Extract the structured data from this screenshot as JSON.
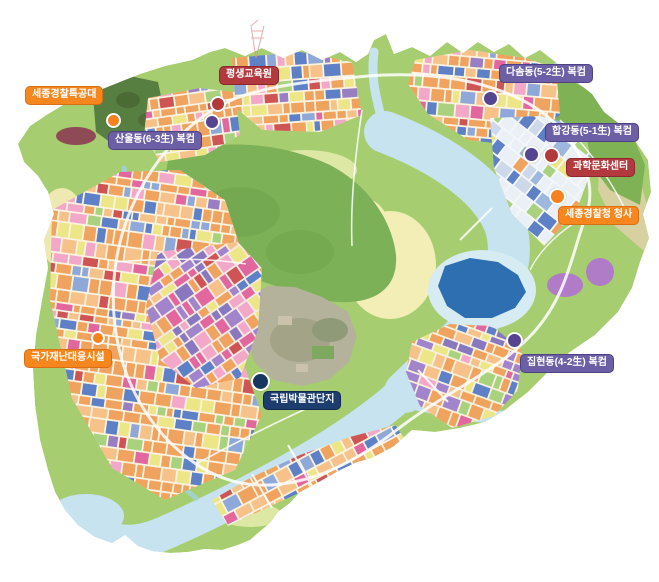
{
  "title": "세종시 시설 위치 지도",
  "colors": {
    "label_orange": "#f6871f",
    "label_orange_border": "#d96e14",
    "label_crimson": "#b23a3e",
    "label_crimson_border": "#8e262e",
    "label_purple": "#6d5fa5",
    "label_purple_border": "#4e4185",
    "label_navy": "#1c3d6e",
    "label_navy_border": "#12294e",
    "dot_orange": "#f5821f",
    "dot_red": "#b23a3a",
    "dot_purple": "#55448f",
    "dot_navy": "#17375f",
    "land_green": "#a6cd6f",
    "river_blue": "#c6e3ef",
    "lake_blue": "#2e6fb2"
  },
  "labels": [
    {
      "id": "sejong-police-swat",
      "text": "세종경찰특공대",
      "variant": "orange",
      "x": 25,
      "y": 86,
      "dot": {
        "x": 113,
        "y": 120,
        "color": "orange",
        "size": 11
      }
    },
    {
      "id": "lifelong-education-center",
      "text": "평생교육원",
      "variant": "crimson",
      "x": 219,
      "y": 66,
      "dot": {
        "x": 218,
        "y": 104,
        "color": "red",
        "size": 12
      }
    },
    {
      "id": "sanul-dong-6-3-bokkeom",
      "text": "산울동(6-3生) 복컴",
      "variant": "purple",
      "x": 108,
      "y": 131,
      "dot": {
        "x": 212,
        "y": 122,
        "color": "purple",
        "size": 12
      }
    },
    {
      "id": "dasom-dong-5-2-bokkeom",
      "text": "다솜동(5-2生) 복컴",
      "variant": "purple",
      "x": 499,
      "y": 64,
      "dot": {
        "x": 490,
        "y": 98,
        "color": "purple",
        "size": 13
      }
    },
    {
      "id": "hapgang-dong-5-1-bokkeom",
      "text": "합강동(5-1生) 복컴",
      "variant": "purple",
      "x": 545,
      "y": 123,
      "dot": {
        "x": 531,
        "y": 154,
        "color": "purple",
        "size": 13
      }
    },
    {
      "id": "science-culture-center",
      "text": "과학문화센터",
      "variant": "crimson",
      "x": 566,
      "y": 158,
      "dot": {
        "x": 551,
        "y": 155,
        "color": "red",
        "size": 13
      }
    },
    {
      "id": "sejong-police-hq",
      "text": "세종경찰청 청사",
      "variant": "orange",
      "x": 558,
      "y": 206,
      "dot": {
        "x": 557,
        "y": 196,
        "color": "orange",
        "size": 13
      }
    },
    {
      "id": "national-disaster-response-facility",
      "text": "국가재난대응시설",
      "variant": "orange",
      "x": 24,
      "y": 349,
      "dot": {
        "x": 98,
        "y": 338,
        "color": "orange",
        "size": 10
      }
    },
    {
      "id": "national-museum-complex",
      "text": "국립박물관단지",
      "variant": "navy",
      "x": 263,
      "y": 391,
      "dot": {
        "x": 260,
        "y": 381,
        "color": "navy",
        "size": 15
      }
    },
    {
      "id": "jiphyeon-dong-4-2-bokkeom",
      "text": "집현동(4-2生) 복컴",
      "variant": "purple",
      "x": 520,
      "y": 354,
      "dot": {
        "x": 514,
        "y": 340,
        "color": "purple",
        "size": 13
      }
    }
  ]
}
